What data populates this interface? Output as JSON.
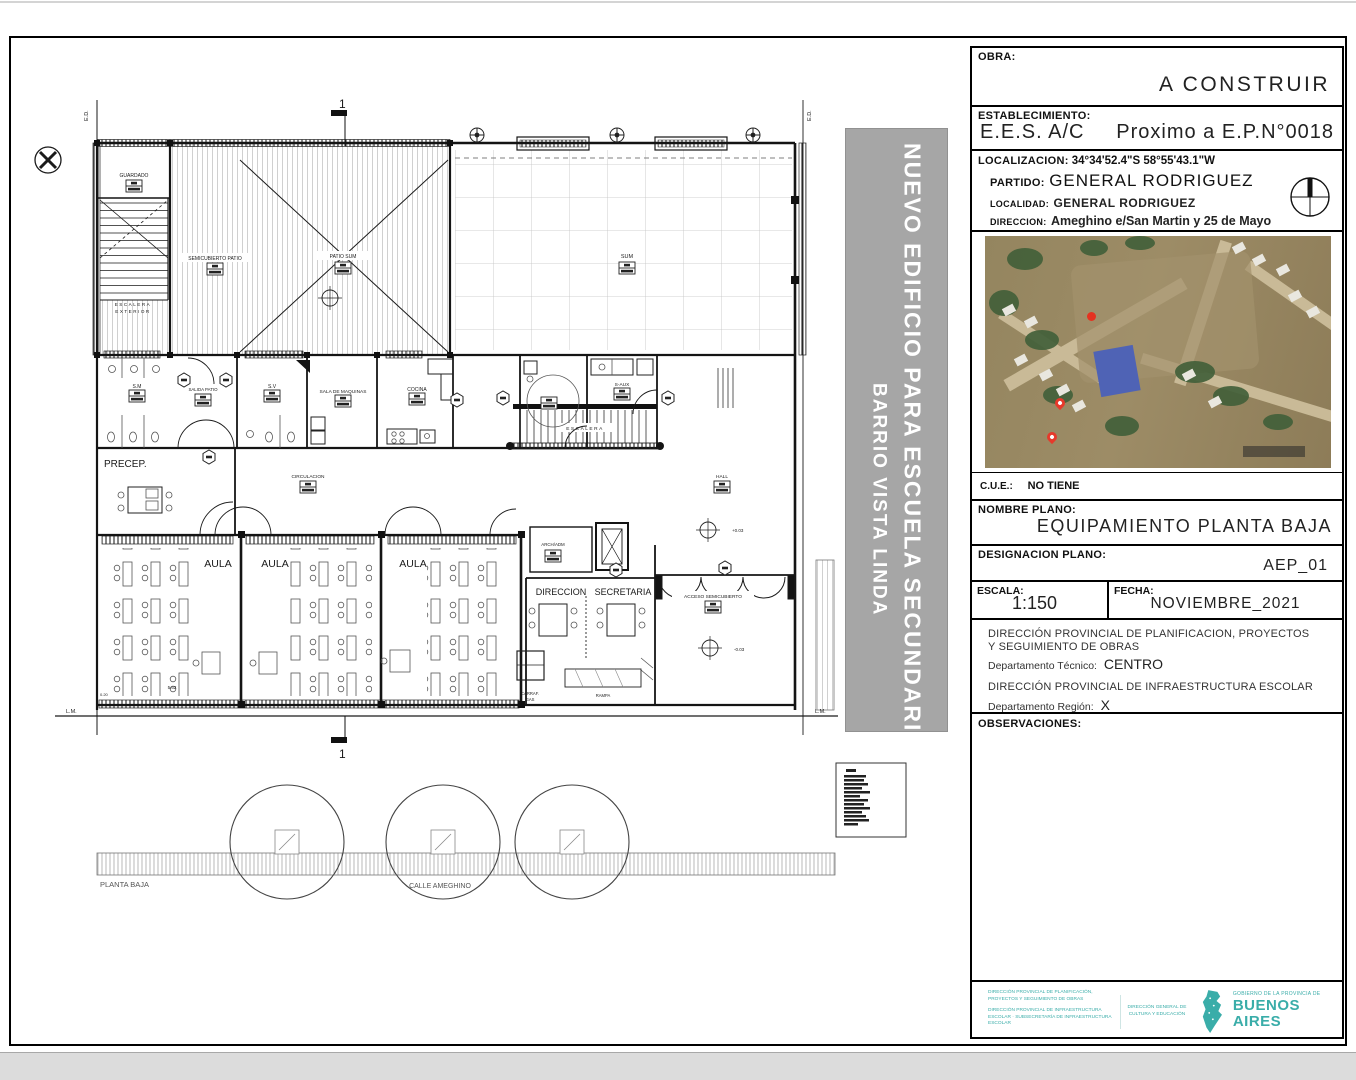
{
  "banner": {
    "line1": "NUEVO EDIFICIO PARA ESCUELA SECUNDARIA",
    "line2": "BARRIO VISTA LINDA"
  },
  "title_block": {
    "obra_label": "OBRA:",
    "obra_value": "A CONSTRUIR",
    "establecimiento_label": "ESTABLECIMIENTO:",
    "establecimiento_value1": "E.E.S. A/C",
    "establecimiento_value2": "Proximo a E.P.N°0018",
    "localizacion_label": "LOCALIZACION:",
    "localizacion_value": "34°34'52.4\"S  58°55'43.1\"W",
    "partido_label": "PARTIDO:",
    "partido_value": "GENERAL RODRIGUEZ",
    "localidad_label": "LOCALIDAD:",
    "localidad_value": "GENERAL RODRIGUEZ",
    "direccion_label": "DIRECCION:",
    "direccion_value": "Ameghino e/San Martin y 25 de Mayo",
    "cue_label": "C.U.E.:",
    "cue_value": "NO TIENE",
    "nombre_plano_label": "NOMBRE PLANO:",
    "nombre_plano_value": "EQUIPAMIENTO PLANTA BAJA",
    "designacion_label": "DESIGNACION PLANO:",
    "designacion_value": "AEP_01",
    "escala_label": "ESCALA:",
    "escala_value": "1:150",
    "fecha_label": "FECHA:",
    "fecha_value": "NOVIEMBRE_2021",
    "dp1_line1": "DIRECCIÓN PROVINCIAL DE PLANIFICACION, PROYECTOS",
    "dp1_line2": "Y SEGUIMIENTO DE OBRAS",
    "dp1_dep_label": "Departamento Técnico:",
    "dp1_dep_value": "CENTRO",
    "dp2_line1": "DIRECCIÓN PROVINCIAL DE INFRAESTRUCTURA ESCOLAR",
    "dp2_dep_label": "Departamento Región:",
    "dp2_dep_value": "X",
    "observaciones_label": "OBSERVACIONES:"
  },
  "footer": {
    "left_block1": "DIRECCIÓN PROVINCIAL DE PLANIFICACIÓN, PROYECTOS Y SEGUIMIENTO DE OBRAS",
    "left_block2": "DIRECCIÓN PROVINCIAL DE INFRAESTRUCTURA ESCOLAR · SUBSECRETARÍA DE INFRAESTRUCTURA ESCOLAR",
    "center_block": "DIRECCIÓN GENERAL DE CULTURA Y EDUCACIÓN",
    "gov_small": "GOBIERNO DE LA PROVINCIA DE",
    "gov_big": "BUENOS AIRES"
  },
  "plan": {
    "labels": {
      "ed": "E.D.",
      "lm": "L.M.",
      "one": "1",
      "guardado": "GUARDADO",
      "escalera_ext1": "ESCALERA",
      "escalera_ext2": "EXTERIOR",
      "semicubierto": "SEMICUBIERTO PATIO",
      "patio_sum": "PATIO SUM",
      "sum": "SUM",
      "sm": "S.M",
      "salida_patio": "SALIDA PATIO",
      "sv": "S.V",
      "sala_maq": "SALA DE MAQUINAS",
      "cocina": "COCINA",
      "s_aux": "S-AUX",
      "escalera": "ESCALERA",
      "precep": "PRECEP.",
      "circulacion": "CIRCULACION",
      "hall": "HALL",
      "aula": "AULA",
      "arch_adm": "ARCH/ADM",
      "direccion": "DIRECCION",
      "secretaria": "SECRETARIA",
      "acceso": "ACCESO SEMICUBIERTO",
      "carraf1": "CARRAF.",
      "carraf2": "GAS",
      "rampa": "RAMPA",
      "planta_baja": "PLANTA BAJA",
      "calle": "CALLE AMEGHINO",
      "lvl_plus": "+0.03",
      "lvl_minus": "-0.03",
      "dim1": "5.62",
      "dim2": "0.20"
    }
  },
  "colors": {
    "teal": "#3aada9",
    "banner_gray": "#a6a6a6",
    "line": "#1a1a1a"
  }
}
